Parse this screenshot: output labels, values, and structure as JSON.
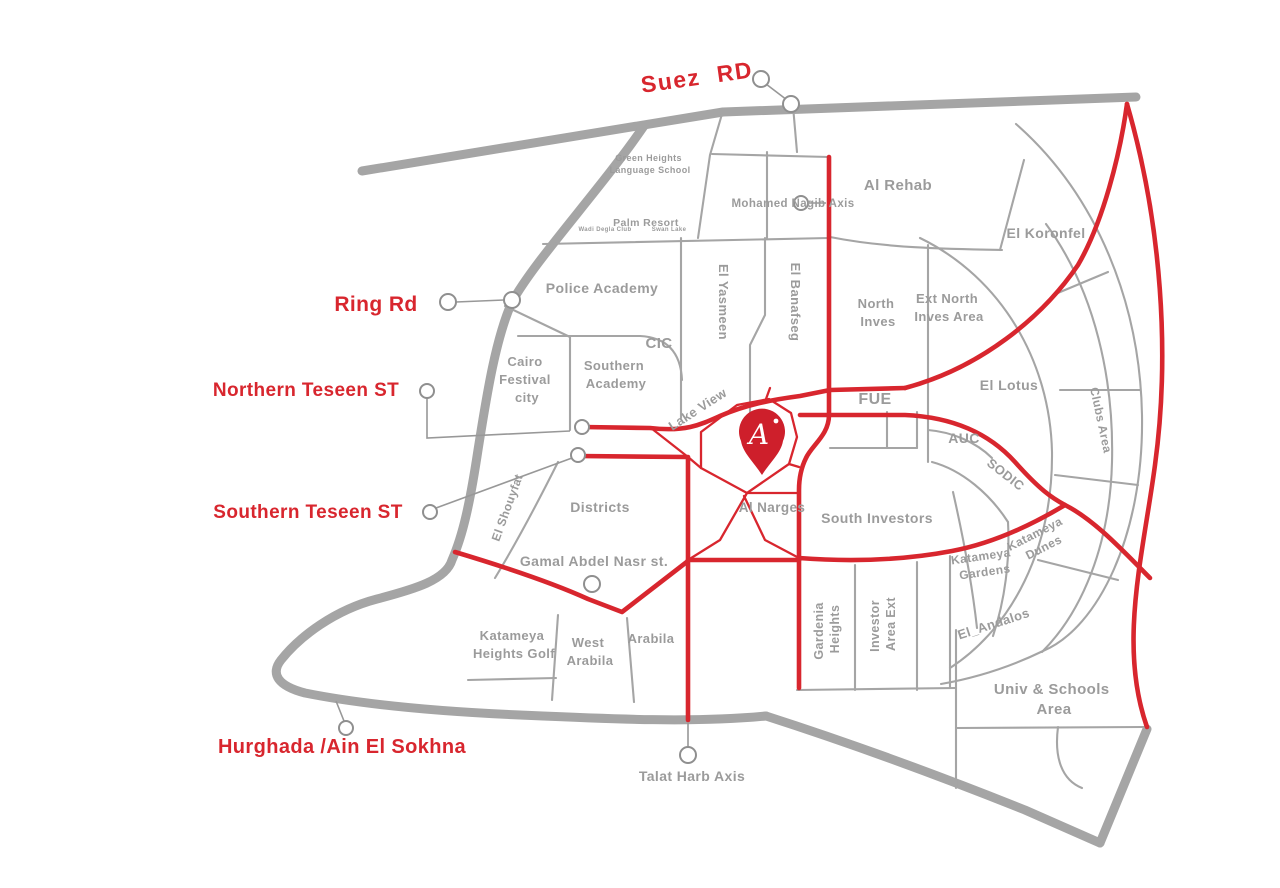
{
  "map": {
    "colors": {
      "road_red": "#D8262E",
      "road_gray": "#A5A5A5",
      "label_gray": "#9B9B9B",
      "pin_red": "#CE1F2B"
    },
    "road_labels": {
      "suez_rd": "Suez RD",
      "ring_rd": "Ring Rd",
      "northern_teseen": "Northern Teseen ST",
      "southern_teseen": "Southern Teseen ST",
      "hurghada_ain_el_sokhna": "Hurghada /Ain El Sokhna",
      "talat_harb_axis": "Talat Harb Axis",
      "mohamed_nagib_axis": "Mohamed Nagib Axis",
      "gamal_abdel_nasr": "Gamal Abdel Nasr st.",
      "lake_view": "Lake View"
    },
    "area_labels": {
      "green_heights": [
        "Green Heights",
        "Language School"
      ],
      "palm_resort": "Palm Resort",
      "wadi_degla_club": "Wadi Degla Club",
      "swan_lake": "Swan Lake",
      "al_rehab": "Al Rehab",
      "el_koronfel": "El Koronfel",
      "police_academy": "Police Academy",
      "el_yasmeen": "El Yasmeen",
      "el_banafseg": "El Banafseg",
      "cic": "CIC",
      "north_inves": [
        "North",
        "Inves"
      ],
      "ext_north_inves": [
        "Ext North",
        "Inves Area"
      ],
      "cairo_festival_city": [
        "Cairo",
        "Festival",
        "city"
      ],
      "southern_academy": [
        "Southern",
        "Academy"
      ],
      "fue": "FUE",
      "el_lotus": "El Lotus",
      "auc": "AUC",
      "sodic": "SODIC",
      "clubs_area": "Clubs Area",
      "katameya_dunes": [
        "Katameya",
        "Dunes"
      ],
      "el_shouyfat": "El Shouyfat",
      "districts": "Districts",
      "al_narges": "Al Narges",
      "south_investors": "South Investors",
      "katameya_gardens": [
        "Katameya",
        "Gardens"
      ],
      "el_andalos": "El_Andalos",
      "katameya_heights_golf": [
        "Katameya",
        "Heights Golf"
      ],
      "west_arabila": [
        "West",
        "Arabila"
      ],
      "arabila": "Arabila",
      "gardenia_heights": [
        "Gardenia",
        "Heights"
      ],
      "investor_area_ext": [
        "Investor",
        "Area Ext"
      ],
      "univ_schools_area": [
        "Univ & Schools",
        "Area"
      ]
    },
    "pin": {
      "letter": "A"
    }
  }
}
